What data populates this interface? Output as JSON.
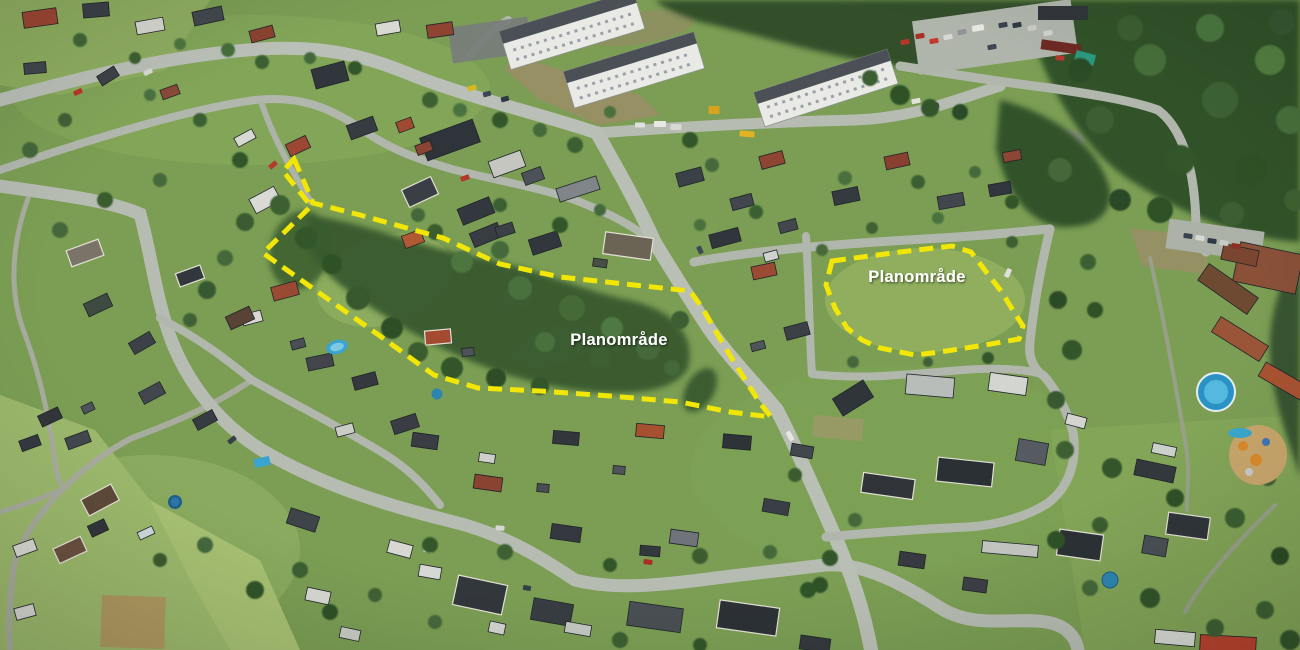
{
  "scene": {
    "type": "aerial-photograph-with-plan-annotations"
  },
  "palette": {
    "grass": "#7b9e54",
    "field_light": "#9cb96c",
    "forest_dark": "#33522b",
    "road_gray": "#b7bcb3",
    "roof_dark": "#32373c",
    "roof_red": "#9a4a33",
    "building_white": "#e9eae6",
    "pool_blue": "#2b93c4",
    "dash_yellow": "#f2e606",
    "label_white": "#ffffff"
  },
  "annotations": {
    "areas": [
      {
        "id": "west-plan-area",
        "label": "Planområde",
        "points": "294,159 305,184 313,203 360,215 443,238 500,264 560,277 625,284 690,291 703,309 722,342 742,375 760,403 771,417 730,412 680,402 610,396 540,391 478,388 434,375 380,336 325,297 263,253 303,214 311,206 283,171"
      },
      {
        "id": "east-plan-area",
        "label": "Planområde",
        "points": "832,261 900,252 952,246 971,252 987,273 1001,291 1014,312 1023,326 1019,339 985,345 940,352 915,355 880,348 862,340 847,328 835,308 826,285"
      }
    ]
  }
}
